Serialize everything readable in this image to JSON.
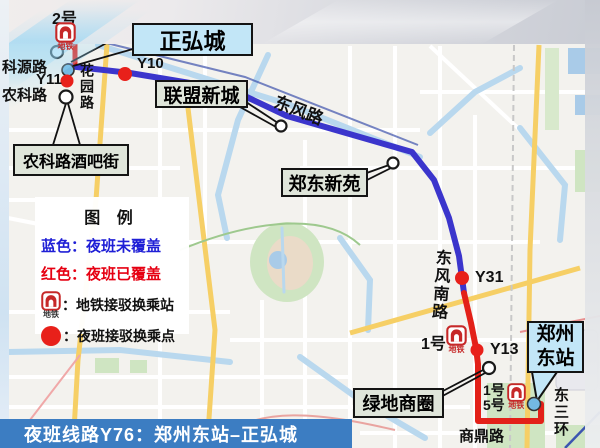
{
  "colors": {
    "route_uncovered_blue": "#3b35cc",
    "route_covered_red": "#e32119",
    "callout_blue": "#c2e6f7",
    "callout_gray_green": "#dfe5da",
    "legend_blue_text": "#1f1fd6",
    "legend_red_text": "#e60012",
    "title_bar_blue": "#3c7dc2"
  },
  "title_bar": {
    "text": "夜班线路Y76：郑州东站–正弘城"
  },
  "legend": {
    "title": "图 例",
    "blue_item": "蓝色：夜班未覆盖",
    "red_item": "红色：夜班已覆盖",
    "metro_item": "：地铁接驳换乘站",
    "night_item": "：夜班接驳换乘点",
    "metro_caption": "地铁"
  },
  "callouts": {
    "zhenghongcheng": {
      "text": "正弘城"
    },
    "lianmengxincheng": {
      "text": "联盟新城"
    },
    "nongkelu_bar_street": {
      "text": "农科路酒吧街"
    },
    "zhengdong_xinyuan": {
      "text": "郑东新苑"
    },
    "lvdi_shangquan": {
      "text": "绿地商圈"
    },
    "zhengzhou_east": {
      "line1": "郑州",
      "line2": "东站"
    }
  },
  "stations": {
    "top": {
      "line_badge": "2号",
      "metro_caption": "地铁"
    },
    "mid": {
      "line_badge": "1号",
      "metro_caption": "地铁"
    },
    "bottom": {
      "line_badge1": "1号",
      "line_badge2": "5号",
      "metro_caption": "地铁"
    }
  },
  "stops": {
    "keyuanlu": "科源路",
    "y11": "Y11",
    "nongkelu": "农科路",
    "y10": "Y10",
    "y31": "Y31",
    "y13": "Y13"
  },
  "roads": {
    "huayuanlu": "花园路",
    "dongfenglu": "东风路",
    "dongfengnanlu": "东风南路",
    "dongsanhuan": "东三环",
    "shangdinglu": "商鼎路"
  }
}
